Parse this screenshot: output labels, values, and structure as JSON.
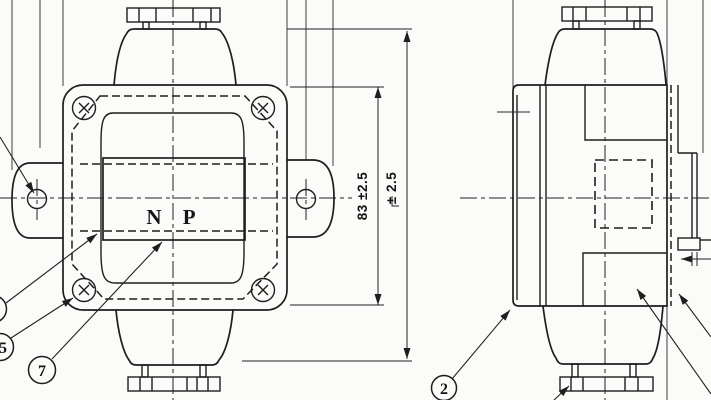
{
  "drawing": {
    "type": "engineering-two-view-drawing",
    "nameplate_text": "N P",
    "dimensions": {
      "body_height": "83 ±2.5",
      "overall_height_tolerance": "± 2.5"
    },
    "callouts": {
      "c2": "2",
      "c5": "5",
      "c7": "7"
    },
    "colors": {
      "paper": "#fbfbf9",
      "ink": "#1e1e1e"
    }
  }
}
